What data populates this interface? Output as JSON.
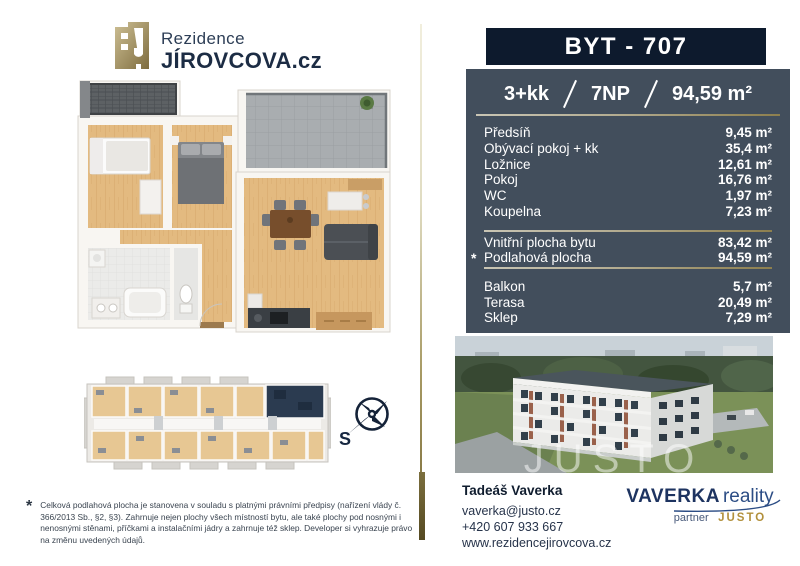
{
  "logo": {
    "line1": "Rezidence",
    "line2": "JÍROVCOVA.cz"
  },
  "compass": {
    "label": "S"
  },
  "unit": {
    "title": "BYT - 707",
    "layout": "3+kk",
    "floor": "7NP",
    "total_area": "94,59 m²",
    "rooms": [
      {
        "label": "Předsíň",
        "value": "9,45 m²"
      },
      {
        "label": "Obývací pokoj + kk",
        "value": "35,4 m²"
      },
      {
        "label": "Ložnice",
        "value": "12,61 m²"
      },
      {
        "label": "Pokoj",
        "value": "16,76 m²"
      },
      {
        "label": "WC",
        "value": "1,97 m²"
      },
      {
        "label": "Koupelna",
        "value": "7,23 m²"
      }
    ],
    "areas": [
      {
        "mark": "",
        "label": "Vnitřní plocha bytu",
        "value": "83,42 m²"
      },
      {
        "mark": "*",
        "label": "Podlahová plocha",
        "value": "94,59 m²"
      }
    ],
    "extras": [
      {
        "label": "Balkon",
        "value": "5,7 m²"
      },
      {
        "label": "Terasa",
        "value": "20,49 m²"
      },
      {
        "label": "Sklep",
        "value": "7,29 m²"
      }
    ]
  },
  "photo": {
    "watermark": "JUSTO"
  },
  "contact": {
    "name": "Tadeáš Vaverka",
    "email": "vaverka@justo.cz",
    "phone": "+420 607 933 667",
    "web": "www.rezidencejirovcova.cz"
  },
  "brand": {
    "name": "VAVERKA",
    "suffix": "reality",
    "partner": "partner",
    "partner_name": "JUSTO"
  },
  "footnote": {
    "symbol": "*",
    "text": "Celková podlahová plocha je stanovena v souladu s platnými právními předpisy (nařízení vlády č. 366/2013 Sb., §2, §3). Zahrnuje nejen plochy všech místností bytu, ale také plochy pod nosnými i nenosnými stěnami, příčkami a instalačními jádry a zahrnuje též sklep. Developer si vyhrazuje právo na změnu uvedených údajů."
  },
  "colors": {
    "navy": "#0d1a2d",
    "panel": "#424e5c",
    "gold": "#8d7f4e",
    "brand_navy": "#1d3360",
    "brand_gold": "#b2903c"
  }
}
